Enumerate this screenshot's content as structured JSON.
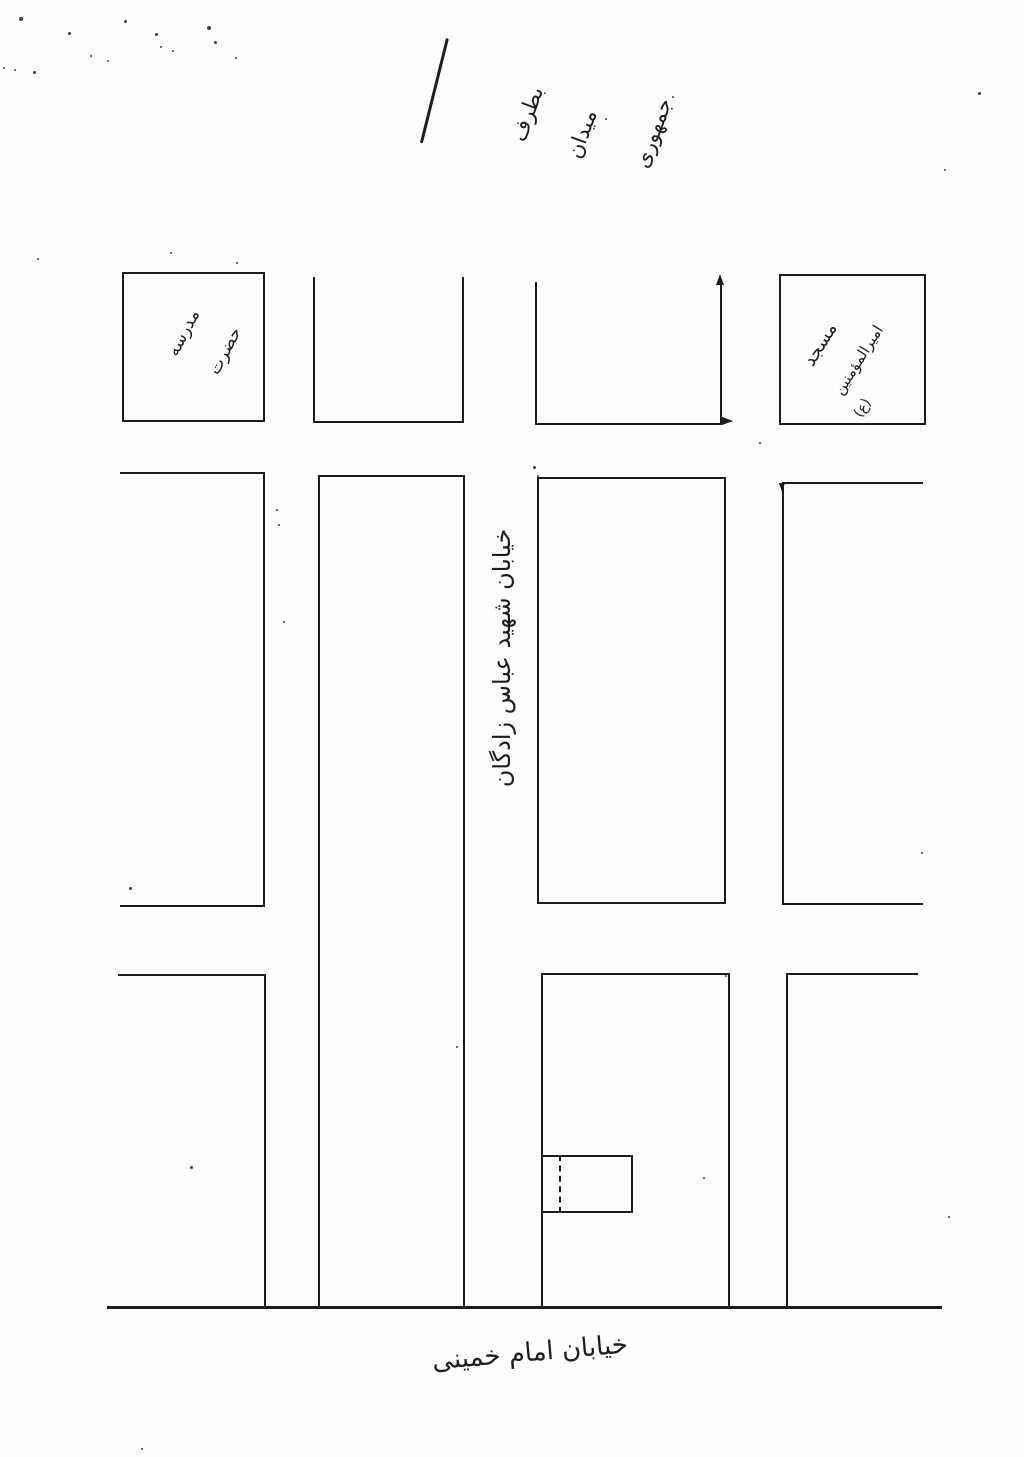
{
  "canvas": {
    "background": "#fdfdfc",
    "ink": "#1d1d1d"
  },
  "header": {
    "arrow_note_words": [
      "بطرف",
      "میدان",
      "جمهوری"
    ]
  },
  "blocks": {
    "school": {
      "label_words": [
        "مدرسه",
        "حضرت"
      ]
    },
    "mosque": {
      "label_words": [
        "مسجد",
        "امیرالمؤمنین",
        "(ع)"
      ]
    }
  },
  "streets": {
    "vertical_main": "خیابان شهید عباس زادگان",
    "bottom_main": "خیابان امام خمینی"
  },
  "noise": {
    "specks": [
      [
        19,
        17,
        4
      ],
      [
        68,
        32,
        3
      ],
      [
        124,
        20,
        3
      ],
      [
        155,
        33,
        3
      ],
      [
        160,
        46,
        2
      ],
      [
        172,
        50,
        2
      ],
      [
        207,
        26,
        4
      ],
      [
        214,
        41,
        3
      ],
      [
        90,
        55,
        2
      ],
      [
        107,
        60,
        2
      ],
      [
        14,
        69,
        2
      ],
      [
        33,
        71,
        3
      ],
      [
        3,
        67,
        2
      ],
      [
        235,
        57,
        2
      ],
      [
        672,
        96,
        2
      ],
      [
        605,
        118,
        2
      ],
      [
        978,
        92,
        3
      ],
      [
        944,
        169,
        2
      ],
      [
        170,
        252,
        2
      ],
      [
        236,
        262,
        2
      ],
      [
        37,
        258,
        2
      ],
      [
        533,
        466,
        3
      ],
      [
        537,
        475,
        2
      ],
      [
        276,
        509,
        2
      ],
      [
        278,
        524,
        2
      ],
      [
        283,
        621,
        2
      ],
      [
        759,
        442,
        2
      ],
      [
        129,
        887,
        3
      ],
      [
        921,
        852,
        2
      ],
      [
        725,
        975,
        2
      ],
      [
        456,
        1046,
        2
      ],
      [
        190,
        1166,
        3
      ],
      [
        703,
        1177,
        2
      ],
      [
        948,
        1216,
        2
      ],
      [
        141,
        1448,
        2
      ]
    ]
  }
}
